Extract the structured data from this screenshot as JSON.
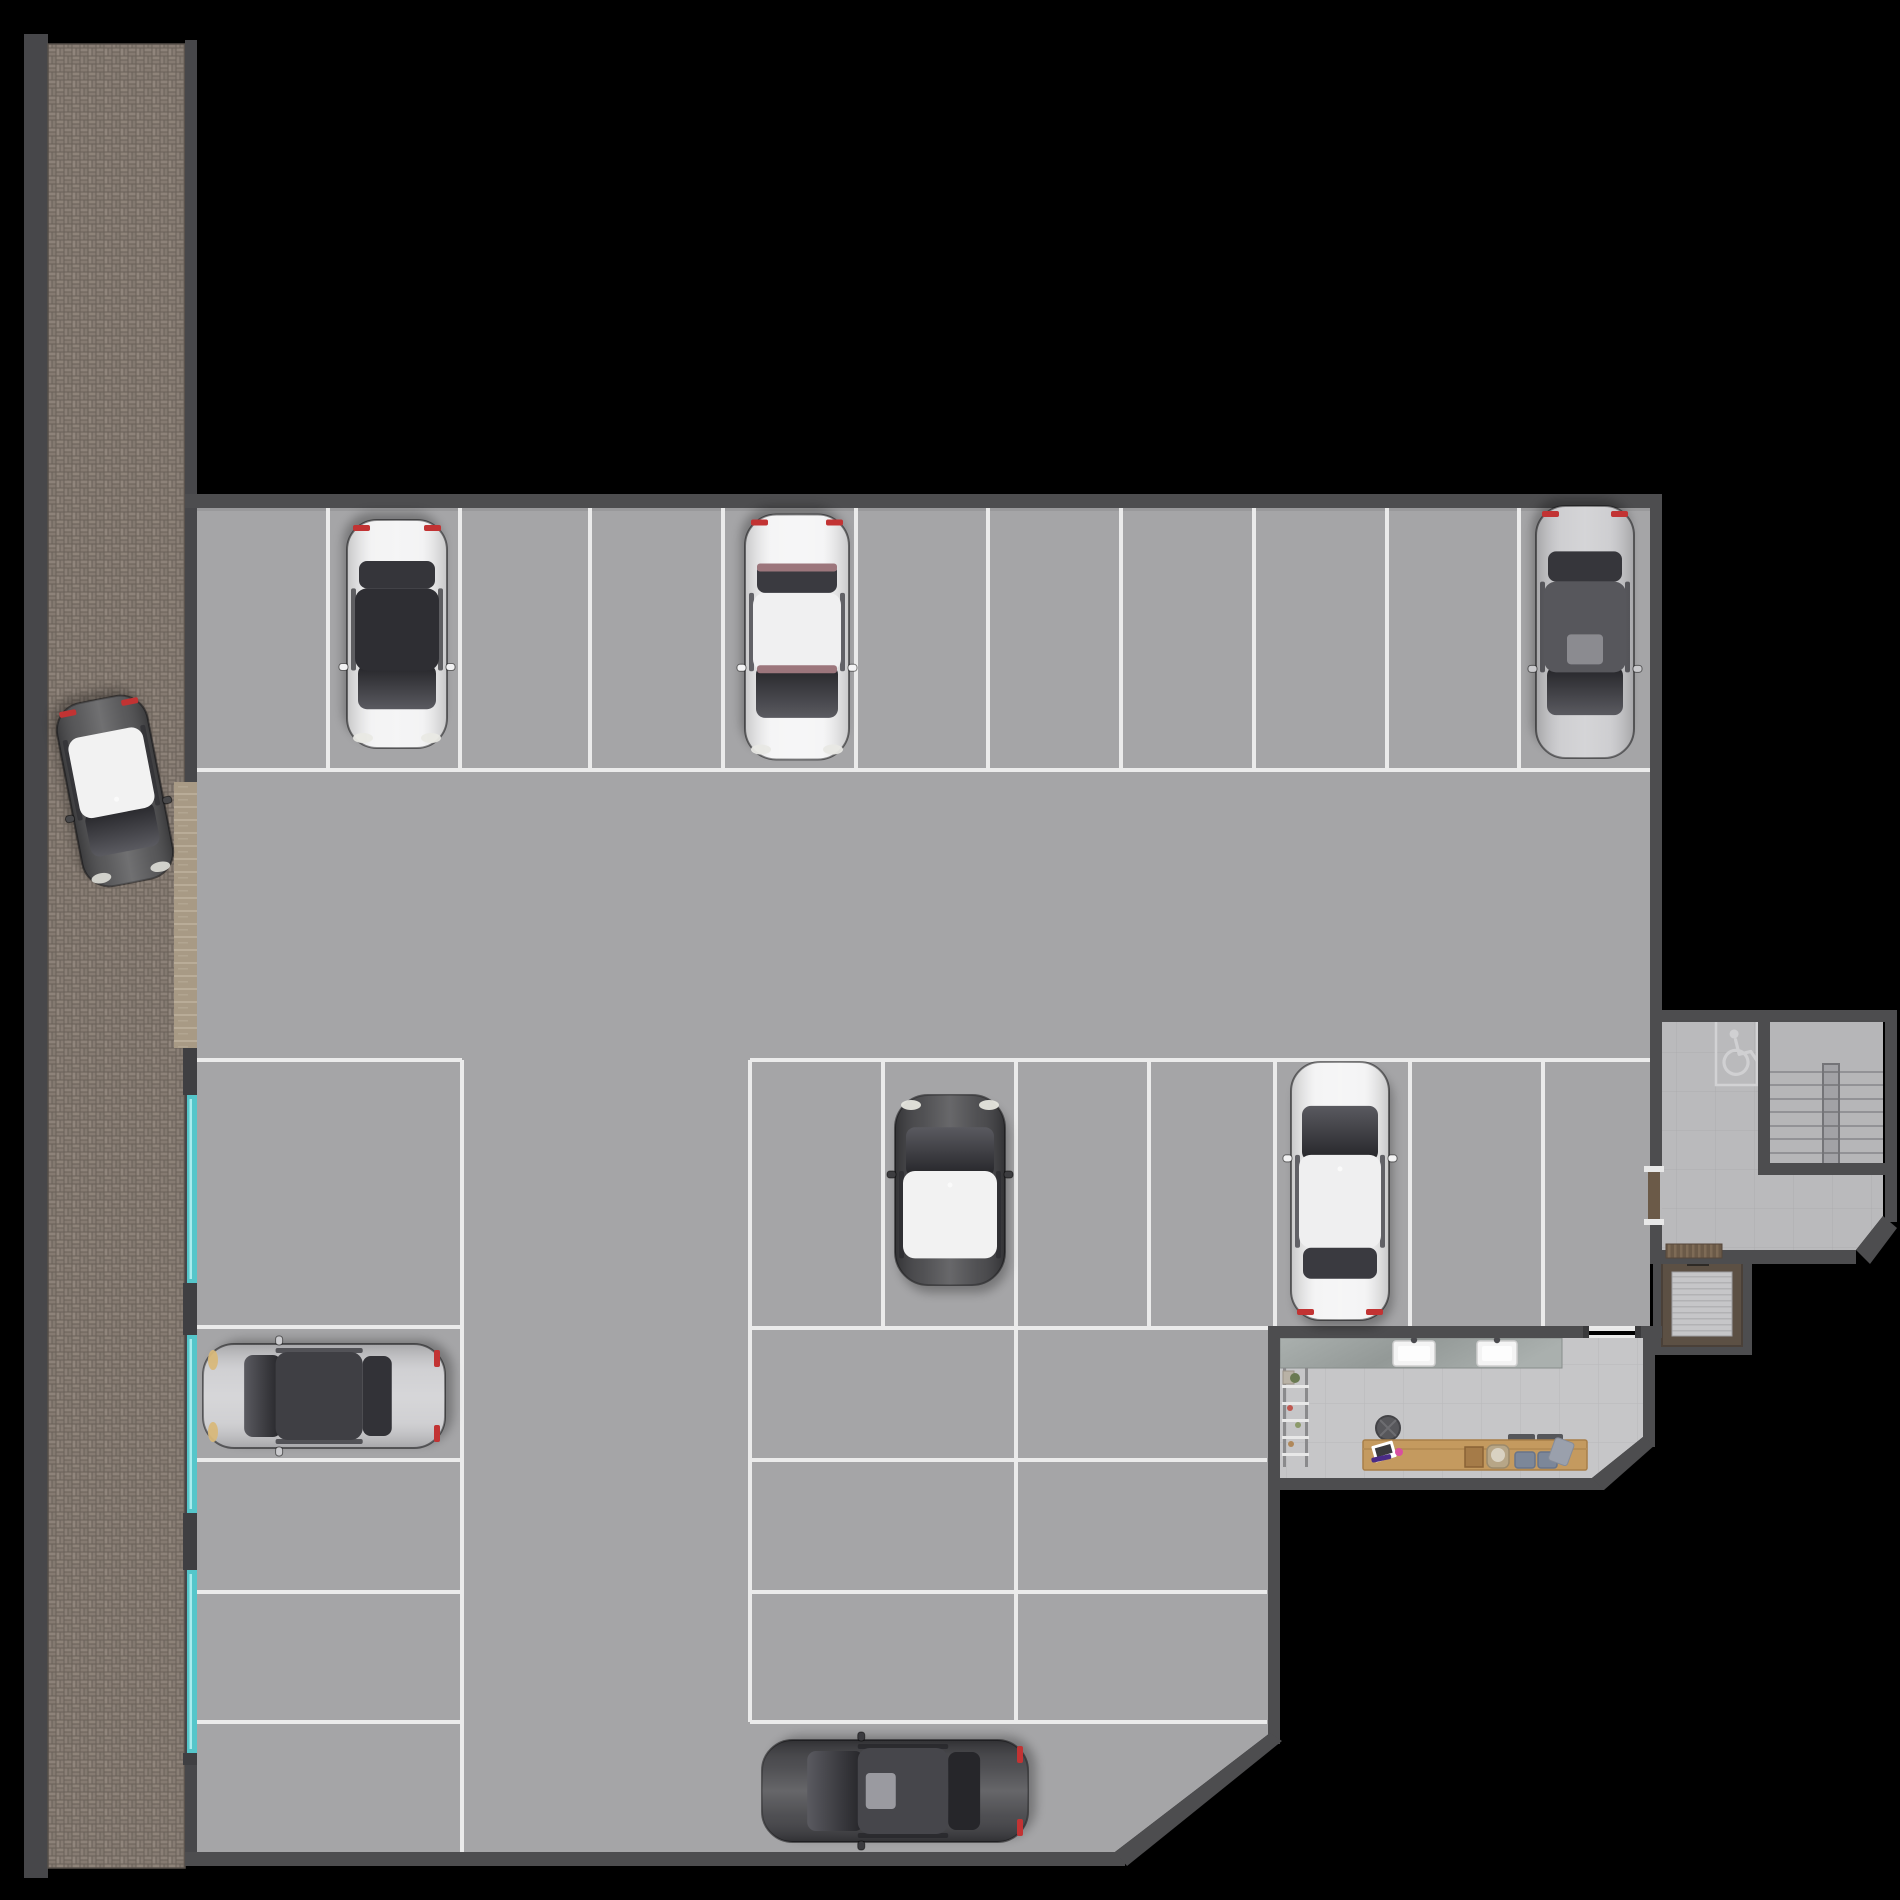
{
  "title": "parking-garage-floor-plan",
  "scene": {
    "width": 1900,
    "height": 1900,
    "background": "#000000"
  },
  "palette": {
    "wall": "#4d4d4f",
    "wall_edge": "#8f8f92",
    "floor": "#a5a5a7",
    "line": "#efefef",
    "sidewalk_bg": "#6a6159",
    "side_wall": "#47474a",
    "ramp": "#a89a85",
    "ramp_tick": "#b9ac98",
    "teal": "#55c6ca",
    "teal_glow": "#a8ecee",
    "lobby_floor": "#bababc",
    "stair_floor": "#b6b6b8",
    "tread": "#929296",
    "rail": "#a2a2a6",
    "rail_edge": "#747478",
    "handicap": "#d2d2d4",
    "elevator_wood": "#5c5044",
    "elevator_floor": "#c6c6c8",
    "elevator_stripe": "#b2b2b4",
    "mat": "#6b5a48",
    "mat_stripe": "#7e6b56",
    "office_floor": "#c6c6c8",
    "counter_a": "#aab0ae",
    "counter_b": "#939997",
    "sink": "#f4f4f4",
    "faucet": "#4a4a4e",
    "desk": "#c49a5f",
    "desk_edge": "#a87f49",
    "stool": "#57575b",
    "cushion": "#7c8799",
    "tray": "#55565a",
    "wood_box": "#a57b48",
    "basket": "#b7a687",
    "towel": "#9aa0ac",
    "tablet": "#ffffff",
    "tablet_screen": "#3a3a3e",
    "pen": "#4a2b86",
    "pink": "#d94fa0",
    "plant": "#6a7a52",
    "taillight": "#c23333",
    "shadow": "#000000"
  },
  "sidewalk": {
    "left_band": [
      24,
      34,
      24,
      1844
    ],
    "brick": [
      48,
      44,
      137,
      1824
    ],
    "right_band_upper": [
      185,
      40,
      12,
      742
    ],
    "right_band_lower": [
      185,
      1048,
      12,
      804
    ],
    "ramp": [
      174,
      782,
      25,
      266
    ],
    "pilasters": [
      [
        183,
        1048,
        16,
        47
      ],
      [
        183,
        1283,
        16,
        52
      ],
      [
        183,
        1513,
        16,
        57
      ],
      [
        183,
        1753,
        16,
        12
      ]
    ],
    "teal_strips": [
      [
        188,
        1095,
        8,
        188
      ],
      [
        188,
        1335,
        8,
        178
      ],
      [
        188,
        1570,
        8,
        183
      ]
    ]
  },
  "floor_polygon": "197,508 1650,508 1650,1328 1270,1328 1270,1733 1115,1852 197,1852",
  "walls_rects": [
    [
      185,
      494,
      1477,
      14
    ],
    [
      1650,
      494,
      12,
      530
    ],
    [
      185,
      1852,
      940,
      14
    ],
    [
      1268,
      1326,
      12,
      418
    ],
    [
      1268,
      1326,
      317,
      12
    ],
    [
      1638,
      1326,
      24,
      12
    ],
    [
      1643,
      1326,
      12,
      121
    ],
    [
      1268,
      1478,
      336,
      12
    ],
    [
      1650,
      1010,
      247,
      12
    ],
    [
      1885,
      1010,
      12,
      212
    ],
    [
      1650,
      1250,
      206,
      14
    ],
    [
      1650,
      1012,
      12,
      156
    ],
    [
      1650,
      1225,
      12,
      27
    ],
    [
      1758,
      1022,
      12,
      153
    ],
    [
      1758,
      1163,
      139,
      12
    ]
  ],
  "walls_polys": [
    "1115,1852 1270,1733 1282,1741 1127,1866",
    "1643,1437 1655,1445 1604,1490 1592,1478",
    "1883,1216 1897,1228 1870,1264 1856,1250"
  ],
  "parking_lines": [
    [
      197,
      770,
      1650,
      770
    ],
    [
      328,
      508,
      328,
      770
    ],
    [
      460,
      508,
      460,
      770
    ],
    [
      590,
      508,
      590,
      770
    ],
    [
      723,
      508,
      723,
      770
    ],
    [
      856,
      508,
      856,
      770
    ],
    [
      988,
      508,
      988,
      770
    ],
    [
      1121,
      508,
      1121,
      770
    ],
    [
      1254,
      508,
      1254,
      770
    ],
    [
      1387,
      508,
      1387,
      770
    ],
    [
      1519,
      508,
      1519,
      770
    ],
    [
      197,
      1060,
      462,
      1060
    ],
    [
      750,
      1060,
      1650,
      1060
    ],
    [
      750,
      1060,
      750,
      1722
    ],
    [
      883,
      1060,
      883,
      1328
    ],
    [
      1016,
      1060,
      1016,
      1722
    ],
    [
      1149,
      1060,
      1149,
      1328
    ],
    [
      1275,
      1060,
      1275,
      1328
    ],
    [
      1410,
      1060,
      1410,
      1328
    ],
    [
      1543,
      1060,
      1543,
      1328
    ],
    [
      750,
      1328,
      1650,
      1328
    ],
    [
      462,
      1060,
      462,
      1852
    ],
    [
      197,
      1327,
      462,
      1327
    ],
    [
      197,
      1460,
      462,
      1460
    ],
    [
      197,
      1592,
      462,
      1592
    ],
    [
      197,
      1722,
      462,
      1722
    ],
    [
      750,
      1460,
      1267,
      1460
    ],
    [
      750,
      1592,
      1267,
      1592
    ],
    [
      750,
      1722,
      1267,
      1722
    ]
  ],
  "lobby": {
    "floor_poly": "1662,1022 1883,1022 1883,1216 1856,1250 1662,1250",
    "stairs_rect": [
      1770,
      1022,
      113,
      141
    ],
    "flight_left": [
      1770,
      1822
    ],
    "flight_right": [
      1840,
      1883
    ],
    "tread_ys": [
      1072,
      1085,
      1099,
      1112,
      1126,
      1139,
      1153
    ],
    "rail": [
      1823,
      1064,
      16,
      104
    ],
    "handicap_box": [
      1716,
      1022,
      41,
      63
    ],
    "door_gap": [
      1650,
      1168,
      12,
      57
    ],
    "door_leaf": [
      1648,
      1172,
      12,
      49
    ],
    "door_caps": [
      [
        1644,
        1166,
        20,
        6
      ],
      [
        1644,
        1219,
        20,
        6
      ]
    ]
  },
  "elevator": {
    "outer": [
      1653,
      1250,
      99,
      105
    ],
    "wood": [
      1662,
      1262,
      80,
      84
    ],
    "floor": [
      1672,
      1272,
      60,
      64
    ],
    "slot": [
      1687,
      1257,
      22,
      9
    ],
    "mat": [
      1666,
      1244,
      56,
      14
    ]
  },
  "office": {
    "floor_poly": "1280,1338 1643,1338 1643,1437 1592,1478 1280,1478",
    "counter": [
      1280,
      1338,
      282,
      30
    ],
    "sinks": [
      [
        1393,
        1341,
        42,
        25
      ],
      [
        1477,
        1341,
        40,
        25
      ]
    ],
    "faucets": [
      [
        1414,
        1340
      ],
      [
        1497,
        1340
      ]
    ],
    "rack_rails": [
      [
        1283,
        1368,
        3,
        99
      ],
      [
        1305,
        1368,
        3,
        99
      ]
    ],
    "rack_shelves_y": [
      1385,
      1402,
      1419,
      1436,
      1453
    ],
    "rack_x": [
      1282,
      1309
    ],
    "stool": [
      1388,
      1428,
      12
    ],
    "desk": [
      1363,
      1440,
      224,
      30
    ],
    "tablet": [
      1373,
      1443,
      22,
      17
    ],
    "pen": [
      1371,
      1458,
      20,
      5
    ],
    "pink": [
      1399,
      1452,
      4
    ],
    "wood_box": [
      1465,
      1447,
      18,
      20
    ],
    "basket": [
      1487,
      1445,
      22,
      23
    ],
    "cushions": [
      [
        1515,
        1452,
        20,
        16
      ],
      [
        1538,
        1452,
        19,
        16
      ]
    ],
    "trays": [
      [
        1508,
        1434,
        27,
        10
      ],
      [
        1537,
        1434,
        26,
        10
      ]
    ],
    "towel": [
      1556,
      1437,
      20,
      24
    ],
    "plant": [
      1295,
      1378
    ],
    "door_rails": [
      [
        1585,
        1328,
        53,
        3
      ],
      [
        1585,
        1335,
        53,
        3
      ]
    ],
    "door_posts": [
      [
        1583,
        1326,
        6,
        12
      ],
      [
        1635,
        1326,
        6,
        12
      ]
    ]
  },
  "cars": [
    {
      "name": "sidewalk-car",
      "cx": 115,
      "cy": 791,
      "w": 92,
      "len": 186,
      "rot": 169,
      "body": "#48484a",
      "roof": "#f2f2f2",
      "roofSpan": [
        0.38,
        0.82
      ],
      "glass": "#303034",
      "tails": true,
      "heads": "#d8d8d2",
      "dot": true
    },
    {
      "name": "top-row-white-hatchback",
      "cx": 397,
      "cy": 634,
      "w": 100,
      "len": 228,
      "rot": 180,
      "body": "#f2f2f3",
      "roof": "#2e2e33",
      "roofSpan": [
        0.34,
        0.7
      ],
      "glass": "#35353a",
      "tails": true,
      "heads": "#e9e9e4"
    },
    {
      "name": "top-row-luxury-sedan",
      "cx": 797,
      "cy": 637,
      "w": 104,
      "len": 245,
      "rot": 180,
      "body": "#f4f4f5",
      "roof": "#f0f0f1",
      "roofSpan": [
        0.36,
        0.68
      ],
      "glass": "#3a3a40",
      "tails": true,
      "heads": "#e8e8e4",
      "dash": "#9c767c"
    },
    {
      "name": "top-row-silver-sedan",
      "cx": 1585,
      "cy": 632,
      "w": 98,
      "len": 252,
      "rot": 180,
      "body": "#c9c9cc",
      "roof": "#57575c",
      "roofSpan": [
        0.34,
        0.7
      ],
      "glass": "#36363b",
      "tails": true,
      "sunroof": "#8b8b90"
    },
    {
      "name": "mini-hatchback",
      "cx": 950,
      "cy": 1190,
      "w": 110,
      "len": 190,
      "rot": 0,
      "body": "#3d3d40",
      "roof": "#f2f2f2",
      "roofSpan": [
        0.4,
        0.86
      ],
      "glass": "#2c2c30",
      "tails": false,
      "heads": "#e6e6de",
      "dot": true
    },
    {
      "name": "white-suv",
      "cx": 1340,
      "cy": 1191,
      "w": 98,
      "len": 258,
      "rot": 0,
      "body": "#f3f3f4",
      "roof": "#efeff0",
      "roofSpan": [
        0.36,
        0.72
      ],
      "glass": "#3a3a40",
      "tails": true,
      "dot": true
    },
    {
      "name": "silver-coupe",
      "cx": 324,
      "cy": 1396,
      "w": 104,
      "len": 242,
      "rot": -90,
      "body": "#cbcbce",
      "roof": "#3f3f44",
      "roofSpan": [
        0.3,
        0.66
      ],
      "glass": "#323237",
      "tails": true,
      "heads": "#d8b87a"
    },
    {
      "name": "dark-sports-car",
      "cx": 895,
      "cy": 1791,
      "w": 102,
      "len": 266,
      "rot": -90,
      "body": "#3b3b3f",
      "roof": "#46464b",
      "roofSpan": [
        0.36,
        0.7
      ],
      "glass": "#26262a",
      "tails": true,
      "sunroof": "#9a9aa0"
    }
  ]
}
